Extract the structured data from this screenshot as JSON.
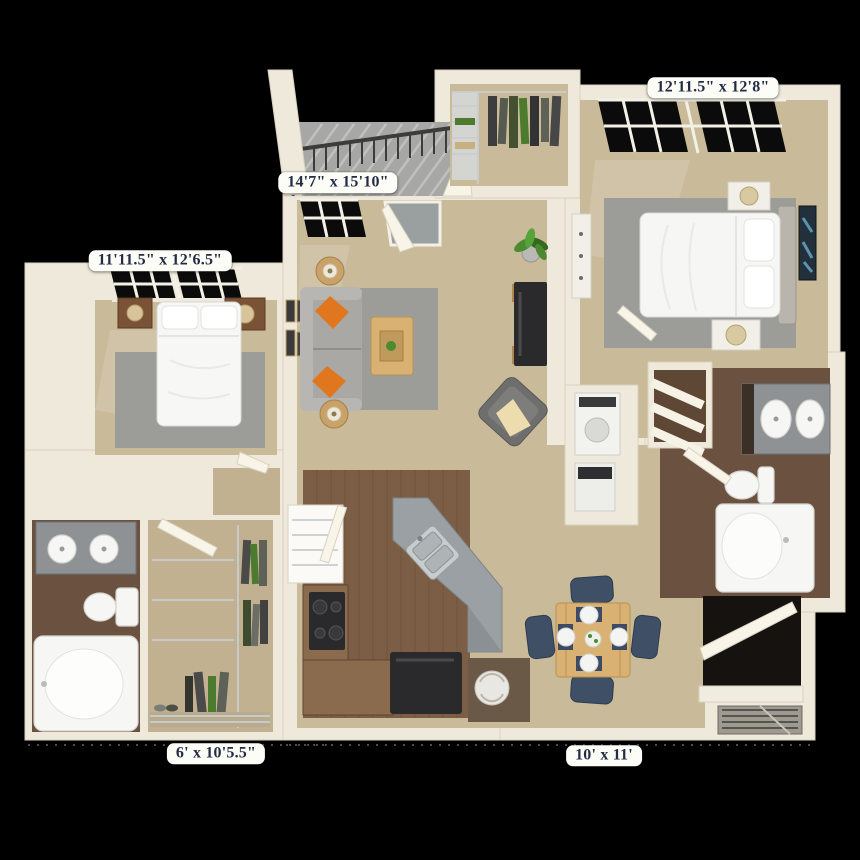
{
  "scene": {
    "type": "3d-floor-plan-render",
    "description": "Top-down 3D rendering of a two-bedroom, two-bathroom apartment floor plan with balcony, on a black background",
    "background": "#000000"
  },
  "labels": {
    "master_bedroom": "12'11.5\" x 12'8\"",
    "living_room": "14'7\" x 15'10\"",
    "bedroom_2": "11'11.5\" x 12'6.5\"",
    "walk_in_closet": "6' x 10'5.5\"",
    "dining_area": "10' x 11'"
  },
  "rooms": [
    {
      "name": "bedroom-2",
      "dimensions": "11'11.5\" x 12'6.5\"",
      "furniture": [
        "queen-bed",
        "nightstand-left",
        "nightstand-right",
        "table-lamps",
        "area-rug",
        "windows"
      ]
    },
    {
      "name": "living-room",
      "dimensions": "14'7\" x 15'10\"",
      "furniture": [
        "sofa",
        "orange-throw-pillows",
        "round-side-tables",
        "coffee-table",
        "area-rug",
        "media-console",
        "accent-chair",
        "potted-plant",
        "wall-art",
        "balcony-door",
        "window"
      ]
    },
    {
      "name": "master-bedroom",
      "dimensions": "12'11.5\" x 12'8\"",
      "furniture": [
        "queen-bed",
        "nightstands",
        "dresser",
        "wall-art",
        "area-rug",
        "windows"
      ]
    },
    {
      "name": "walk-in-closet",
      "dimensions": "6' x 10'5.5\"",
      "furniture": [
        "wire-shelving",
        "hanging-clothes",
        "shoes"
      ]
    },
    {
      "name": "dining-area",
      "dimensions": "10' x 11'",
      "furniture": [
        "dining-table",
        "four-chairs",
        "place-settings",
        "centerpiece"
      ]
    },
    {
      "name": "kitchen",
      "furniture": [
        "l-shaped-counter",
        "cooktop",
        "angled-breakfast-bar",
        "double-sink",
        "dishwasher",
        "pantry"
      ]
    },
    {
      "name": "bathroom-1",
      "furniture": [
        "double-sink-vanity",
        "toilet",
        "bathtub"
      ]
    },
    {
      "name": "master-bathroom",
      "furniture": [
        "double-sink-vanity",
        "toilet",
        "bathtub",
        "linen-shelves"
      ]
    },
    {
      "name": "balcony",
      "furniture": [
        "metal-railing",
        "plank-decking"
      ]
    },
    {
      "name": "laundry-closet",
      "furniture": [
        "stacked-washer-dryer"
      ]
    },
    {
      "name": "utility-closet",
      "furniture": [
        "water-heater"
      ]
    },
    {
      "name": "master-closet",
      "furniture": [
        "wire-shelving",
        "hanging-clothes"
      ]
    },
    {
      "name": "patio-storage",
      "furniture": [
        "storage-closet",
        "hvac-grille"
      ]
    }
  ],
  "palette": {
    "background": "#000000",
    "wall": "#efe9db",
    "wall_edge": "#d8d1bf",
    "carpet": "#c9ba99",
    "carpet_dark": "#c2b190",
    "rug": "#9c9c98",
    "wood_kitchen": "#7b5e45",
    "wood_bath": "#6b5140",
    "balcony": "#a7a8a6",
    "counter_gray": "#9aa0a3",
    "cabinet_brown": "#8a6b4e",
    "appliance_dark": "#2a2a2c",
    "sofa": "#a9a8a5",
    "accent_orange": "#e0771f",
    "table_wood": "#d9b273",
    "chair_navy": "#3e4f66",
    "fixture_white": "#f6f6f4",
    "plant_green": "#4c8a31",
    "label_bg": "#fdfdf8",
    "label_text": "#232c44"
  }
}
